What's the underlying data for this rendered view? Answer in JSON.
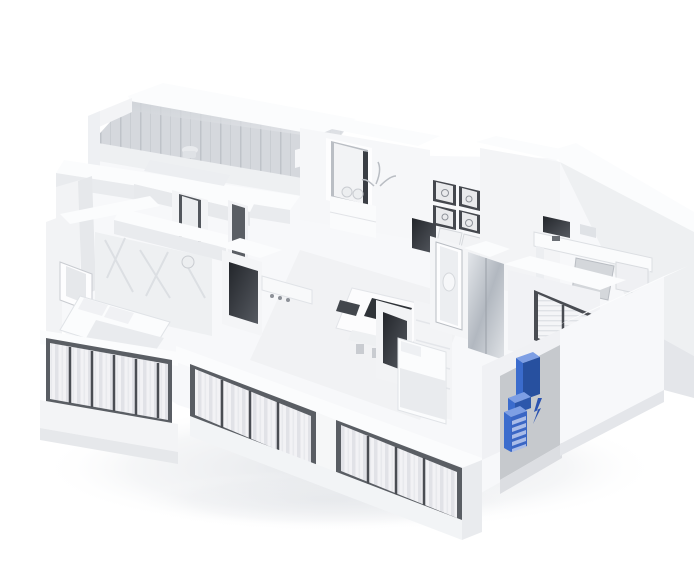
{
  "image": {
    "type": "3d-isometric-floorplan-render",
    "description": "White 3D cutaway model of an apartment seen from above at an angle; rooms contain pale furniture, large front balcony windows with curtains, a glass sunroom at the back, and a single cabinet near the entrance highlighted in blue with a small blue spark mark beside it"
  },
  "palette": {
    "background": "#ffffff",
    "wall_cap": "#fbfcfd",
    "wall_light": "#f4f5f7",
    "wall_shade": "#e7e9ec",
    "wall_deep": "#d8dbdf",
    "edge": "#c9ccd1",
    "glass": "#d6d9dd",
    "glass_stripe": "#c3c7cc",
    "dark_fixture": "#35383e",
    "frame_dark": "#4a4d53",
    "curtain": "#f1f1f4",
    "curtain_stripe": "#e2e3e7",
    "mullion": "#6f7277",
    "mirror_hi": "#e3e6ea",
    "mirror_lo": "#b2b8c0",
    "floor": "#f6f7f9",
    "shadow": "#e6e8eb",
    "entry_wall_gray": "#c6c9cd",
    "highlight_front": "#3b6ccd",
    "highlight_top": "#7e9fe4",
    "highlight_side": "#27509f",
    "highlight_slat": "#a9bce8",
    "spark_blue": "#2a52b0"
  },
  "highlight": {
    "object": "entrance-cabinet",
    "drawer_slats": 5,
    "has_spark_mark": true
  },
  "scene_objects": [
    "glass-sunroom",
    "bathroom",
    "entrance-door",
    "wall-pictures-2x2",
    "dining-area",
    "home-office-desk",
    "living-room-tv",
    "hall-tv",
    "kitchen-island",
    "master-bed",
    "second-bed",
    "mirror-wardrobe",
    "left-balcony-windows",
    "front-balcony-windows",
    "right-window-blinds",
    "highlighted-entrance-cabinet",
    "spark-icon"
  ]
}
